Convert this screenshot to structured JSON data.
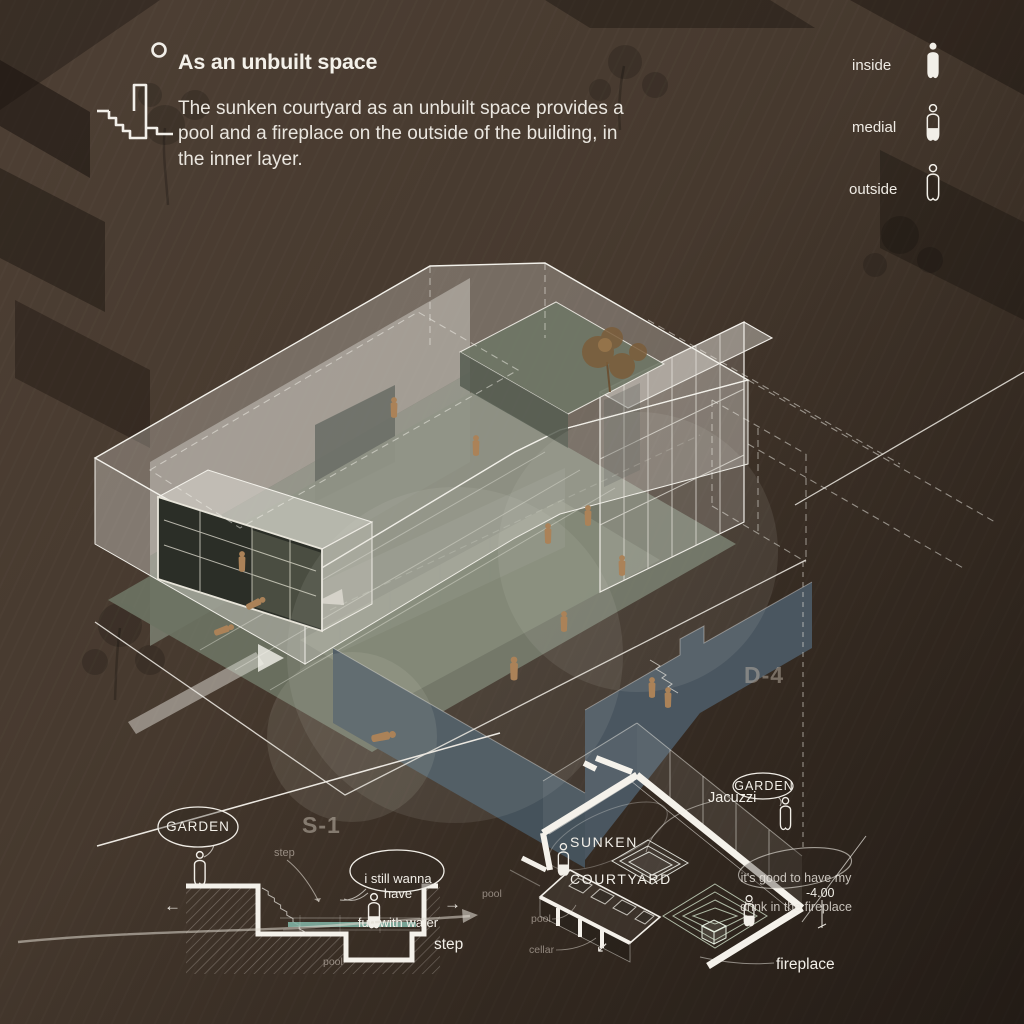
{
  "header": {
    "title": "As an unbuilt space",
    "description": "The sunken courtyard as an unbuilt space provides a pool and a fireplace on the outside of the building, in the inner layer.",
    "icon": "sunken-courtyard-section-icon"
  },
  "legend": {
    "inside": "inside",
    "medial": "medial",
    "outside": "outside"
  },
  "axon_labels": {
    "section_marker": "S-1",
    "detail_marker": "D-4"
  },
  "section_detail": {
    "garden": "GARDEN",
    "step_top": "step",
    "step_right": "step",
    "pool_right": "pool",
    "pool_bottom": "pool",
    "bubble_line1": "i still wanna have",
    "bubble_line2": "fun with water",
    "arrow_left": "←",
    "arrow_right": "→"
  },
  "plan_detail": {
    "title_line1": "SUNKEN",
    "title_line2": "COURTYARD",
    "jacuzzi": "Jacuzzi",
    "garden": "GARDEN",
    "bubble_line1": "it's good to have my",
    "bubble_line2": "drink in the fireplace",
    "level": "-4.00",
    "fireplace": "fireplace",
    "pool": "pool",
    "cellar": "cellar",
    "arrow_sw": "↙"
  },
  "colors": {
    "background": "#47392F",
    "text": "#F2EFE8",
    "slate_wall": "#46535C",
    "sage_floor": "#6C7363",
    "figure": "#AA8159",
    "water": "#7FB0A2"
  }
}
